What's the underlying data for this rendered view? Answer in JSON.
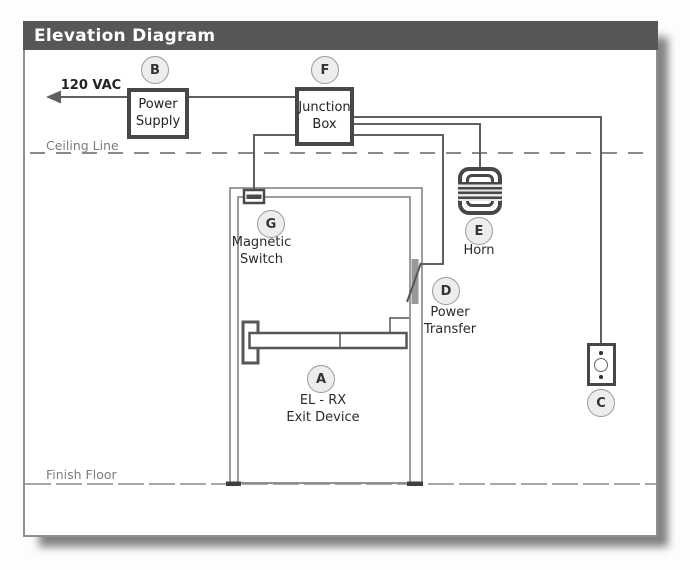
{
  "title": "Elevation Diagram",
  "annotations": {
    "voltage": "120 VAC",
    "ceiling": "Ceiling Line",
    "floor": "Finish Floor"
  },
  "boxes": {
    "power_supply": {
      "lines": [
        "Power",
        "Supply"
      ]
    },
    "junction_box": {
      "lines": [
        "Junction",
        "Box"
      ]
    }
  },
  "components": {
    "a": {
      "letter": "A",
      "label_lines": [
        "EL - RX",
        "Exit Device"
      ]
    },
    "b": {
      "letter": "B"
    },
    "c": {
      "letter": "C"
    },
    "d": {
      "letter": "D",
      "label_lines": [
        "Power",
        "Transfer"
      ]
    },
    "e": {
      "letter": "E",
      "label_lines": [
        "Horn"
      ]
    },
    "f": {
      "letter": "F"
    },
    "g": {
      "letter": "G",
      "label_lines": [
        "Magnetic",
        "Switch"
      ]
    }
  },
  "colors": {
    "title_bar": "#575757",
    "box_border": "#474747",
    "wire": "#5f5f5f",
    "door_line": "#8c8c8c",
    "badge_fill": "#ededed"
  }
}
